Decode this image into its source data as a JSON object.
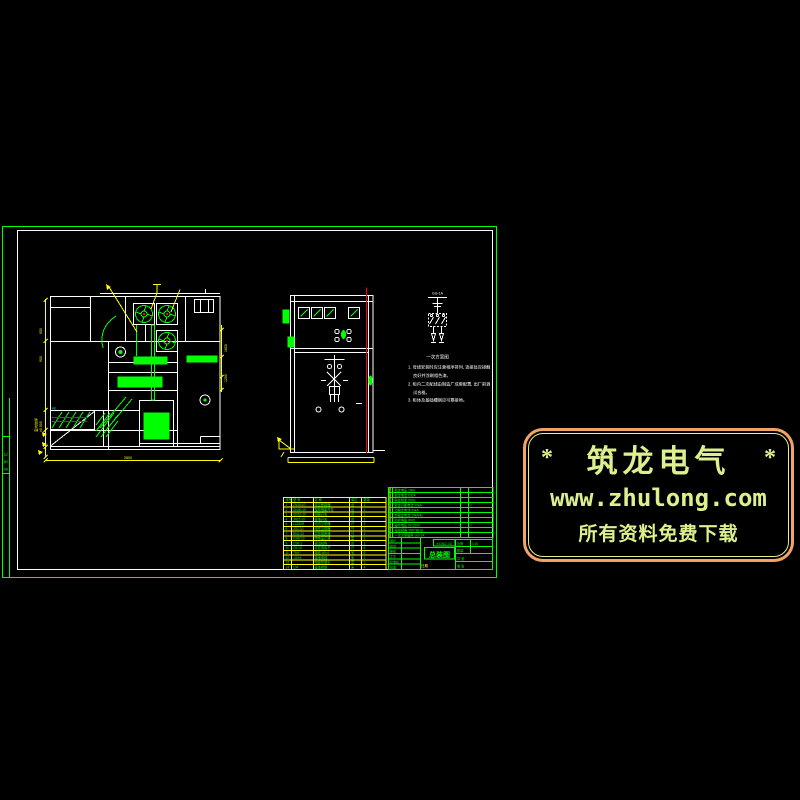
{
  "page": {
    "bg": "#000000",
    "width": 800,
    "height": 800
  },
  "colors": {
    "green": "#00ff00",
    "white": "#ffffff",
    "yellow": "#ffff00",
    "red": "#ff0000",
    "cyan": "#00ffff",
    "badge_outer": "#f1a465",
    "badge_inner": "#ecec82",
    "badge_text": "#dcf18e"
  },
  "sheet": {
    "margin_strip": "会 签 栏"
  },
  "badge": {
    "star_left": "*",
    "title": "筑龙电气",
    "star_right": "*",
    "url": "www.zhulong.com",
    "slogan": "所有资料免费下载"
  },
  "schematic": {
    "label": "GG-1A",
    "caption": "一次方案图"
  },
  "left_view": {
    "dim_bottom": "2800",
    "dim_left_top": "650",
    "dim_left_mid": "900",
    "dim_left_block": "±0.000",
    "dim_left_block2": "室内地坪",
    "dim_right_top": "1600",
    "dim_right_mid": "1200",
    "cable_label": "PE"
  },
  "notes_lines": [
    {
      "x": 408,
      "y": 368.5,
      "t": "1. 母线安装时应注意相序排列, 连接处应接触"
    },
    {
      "x": 413,
      "y": 377.0,
      "t": "良好并涂刷相色漆。"
    },
    {
      "x": 408,
      "y": 385.5,
      "t": "2. 柜内二次配线由制造厂成套配置, 出厂前调"
    },
    {
      "x": 413,
      "y": 394.0,
      "t": "试合格。"
    },
    {
      "x": 408,
      "y": 401.5,
      "t": "3. 柜体及基础槽钢应可靠接地。"
    }
  ],
  "title_block": {
    "drawing_no": "XGN2-10",
    "title": "总装图",
    "date_label": "日期",
    "scale_label": "比例",
    "scale": "1:10",
    "qty_label": "数量",
    "sheet_total": "共 张",
    "sheet_no": "第 张"
  },
  "markers": {
    "#ff0000": [
      [
        113,
        279.5,
        3.5,
        4
      ],
      [
        117.5,
        279.5,
        3.5,
        4
      ],
      [
        131,
        315
      ],
      [
        154,
        311
      ],
      [
        154,
        339
      ],
      [
        176,
        336
      ],
      [
        147,
        354
      ],
      [
        163,
        356
      ],
      [
        113.5,
        377
      ],
      [
        161,
        377
      ],
      [
        110,
        357
      ],
      [
        133,
        393
      ],
      [
        152,
        410
      ],
      [
        160,
        370
      ],
      [
        119,
        343
      ],
      [
        218,
        356
      ],
      [
        88,
        416,
        3,
        2
      ],
      [
        88,
        420,
        3,
        2
      ],
      [
        91,
        418,
        3,
        2
      ],
      [
        284.5,
        314.5,
        3,
        3
      ],
      [
        289,
        340.5,
        3,
        3
      ],
      [
        356.5,
        283.5,
        5,
        4
      ],
      [
        360.5,
        452.5,
        6.5,
        3
      ]
    ],
    "#00ff00": [
      [
        167.5,
        442.5,
        9,
        5
      ],
      [
        179.5,
        442.5,
        9,
        5
      ],
      [
        190.5,
        444,
        6,
        4
      ],
      [
        198.5,
        445,
        5,
        3
      ],
      [
        206.5,
        445,
        5,
        3
      ],
      [
        45,
        446,
        3,
        3
      ],
      [
        57,
        446,
        3,
        3
      ],
      [
        307,
        296.5,
        13,
        3
      ],
      [
        322,
        296.5,
        13,
        3
      ],
      [
        337,
        296.5,
        14,
        3
      ],
      [
        186.5,
        407.5,
        10,
        6
      ]
    ],
    "#ffff00": [
      [
        130,
        452.5,
        4,
        4
      ],
      [
        137.5,
        452.5,
        4,
        4
      ],
      [
        145,
        452.5,
        4,
        4
      ],
      [
        152.5,
        452.5,
        4,
        4
      ],
      [
        160,
        452.5,
        4,
        4
      ],
      [
        167.5,
        452.5,
        4,
        4
      ],
      [
        327.5,
        458,
        2.5,
        4
      ],
      [
        331,
        458,
        2.5,
        4
      ],
      [
        334.5,
        458,
        2.5,
        4
      ],
      [
        338,
        458,
        2.5,
        4
      ],
      [
        177.5,
        284.5,
        5,
        5
      ],
      [
        472,
        547.5,
        6,
        2
      ],
      [
        481,
        555,
        6,
        2
      ],
      [
        472,
        562.5,
        5,
        2
      ],
      [
        483,
        562.5,
        5,
        2
      ],
      [
        391,
        536.2,
        5,
        1.6
      ],
      [
        403.5,
        536.2,
        5,
        1.6
      ],
      [
        416,
        536.2,
        5,
        1.6
      ],
      [
        428.5,
        536.2,
        5,
        1.6
      ],
      [
        441,
        536.2,
        5,
        1.6
      ],
      [
        453.5,
        536.2,
        5,
        1.6
      ],
      [
        466,
        536.2,
        5,
        1.6
      ],
      [
        478.5,
        536.2,
        5,
        1.6
      ]
    ],
    "#ffffff": [
      [
        206,
        356,
        8,
        2.5
      ],
      [
        369.5,
        315,
        2,
        3
      ],
      [
        369.5,
        345,
        2,
        3
      ],
      [
        369.5,
        385,
        2,
        3
      ],
      [
        369.5,
        425,
        2,
        3
      ],
      [
        291.5,
        310,
        2,
        3
      ],
      [
        291.5,
        340,
        2,
        3
      ],
      [
        291.5,
        390,
        2,
        3
      ],
      [
        291.5,
        430,
        2,
        3
      ]
    ],
    "#00ffff": [
      [
        59,
        407,
        5,
        2.5
      ]
    ]
  },
  "tables": {
    "parts": {
      "x": 283.5,
      "y": 497.5,
      "w": 102.5,
      "rowH": 4.8,
      "line": "#ffff00",
      "tick": "#ffff00",
      "fs": 3.2,
      "tc": "#00ff00",
      "vlines": [
        8,
        30,
        66,
        78
      ],
      "cols": [
        {
          "x": 2
        },
        {
          "x": 9.5
        },
        {
          "x": 31
        },
        {
          "x": 67.5
        },
        {
          "x": 80
        }
      ],
      "rows": [
        [
          "序号",
          "型 号",
          "名 称",
          "单位",
          "数量"
        ],
        [
          "1",
          "ZN28-10",
          "真空断路器",
          "台",
          "1"
        ],
        [
          "2",
          "GN30-10",
          "旋转隔离开关",
          "台",
          "1"
        ],
        [
          "3",
          "GN19-10",
          "隔离开关",
          "台",
          "1"
        ],
        [
          "4",
          "JN15-10",
          "接地开关",
          "台",
          "1"
        ],
        [
          "5",
          "LZZBJ9",
          "电流互感器",
          "只",
          "2"
        ],
        [
          "6",
          "JDZ-10",
          "电压互感器",
          "只",
          "2"
        ],
        [
          "7",
          "RN2-10",
          "高压熔断器",
          "只",
          "3"
        ],
        [
          "8",
          "GSN-10",
          "带电显示器",
          "套",
          "1"
        ],
        [
          "9",
          "CS6-1",
          "操动机构",
          "台",
          "1"
        ],
        [
          "10",
          "ZS-10",
          "支柱绝缘子",
          "只",
          "6"
        ],
        [
          "11",
          "TMY",
          "母线 40×4",
          "米",
          "6"
        ],
        [
          "12",
          "-40×4",
          "接地母线",
          "米",
          "2"
        ],
        [
          "13",
          "",
          "电缆终端头",
          "套",
          "1"
        ],
        [
          "14",
          "10#",
          "基础槽钢",
          "米",
          "4"
        ]
      ]
    },
    "spec": {
      "x": 388.5,
      "y": 487.5,
      "w": 104.5,
      "rowH": 5,
      "line": "#00ff00",
      "tick": "#ffff00",
      "fs": 3.2,
      "tc": "#00ff00",
      "vlines": [
        4,
        72,
        80
      ],
      "cols": [
        {
          "x": 6
        },
        {
          "x": 73.5
        },
        {
          "x": 81.5
        }
      ],
      "rows": [
        [
          "额定电压 10kV",
          "",
          ""
        ],
        [
          "额定电流 630A",
          "",
          ""
        ],
        [
          "额定频率 50Hz",
          "",
          ""
        ],
        [
          "额定开断电流 25kA",
          "",
          "√"
        ],
        [
          "动稳定电流 63kA",
          "",
          ""
        ],
        [
          "热稳定电流 25kA/4s",
          "",
          ""
        ],
        [
          "防护等级 IP4X",
          "",
          ""
        ],
        [
          "操作电压 DC220V",
          "",
          "√"
        ],
        [
          "母线规格 TMY-80×8",
          "",
          ""
        ],
        [
          "一次方案编号 GG-1A",
          "",
          ""
        ]
      ]
    },
    "sign": {
      "x": 388.5,
      "y": 537.5,
      "w": 32,
      "rowH": 5.33,
      "line": "#00ff00",
      "fs": 3,
      "tc": "#00ff00",
      "vlines": [
        13
      ],
      "cols": [
        {
          "x": 1.5
        },
        {
          "x": 14.5
        }
      ],
      "rows": [
        [
          "设计",
          ""
        ],
        [
          "校对",
          ""
        ],
        [
          "审核",
          ""
        ],
        [
          "工艺",
          ""
        ],
        [
          "标准化",
          ""
        ],
        [
          "批准",
          ""
        ]
      ]
    }
  }
}
